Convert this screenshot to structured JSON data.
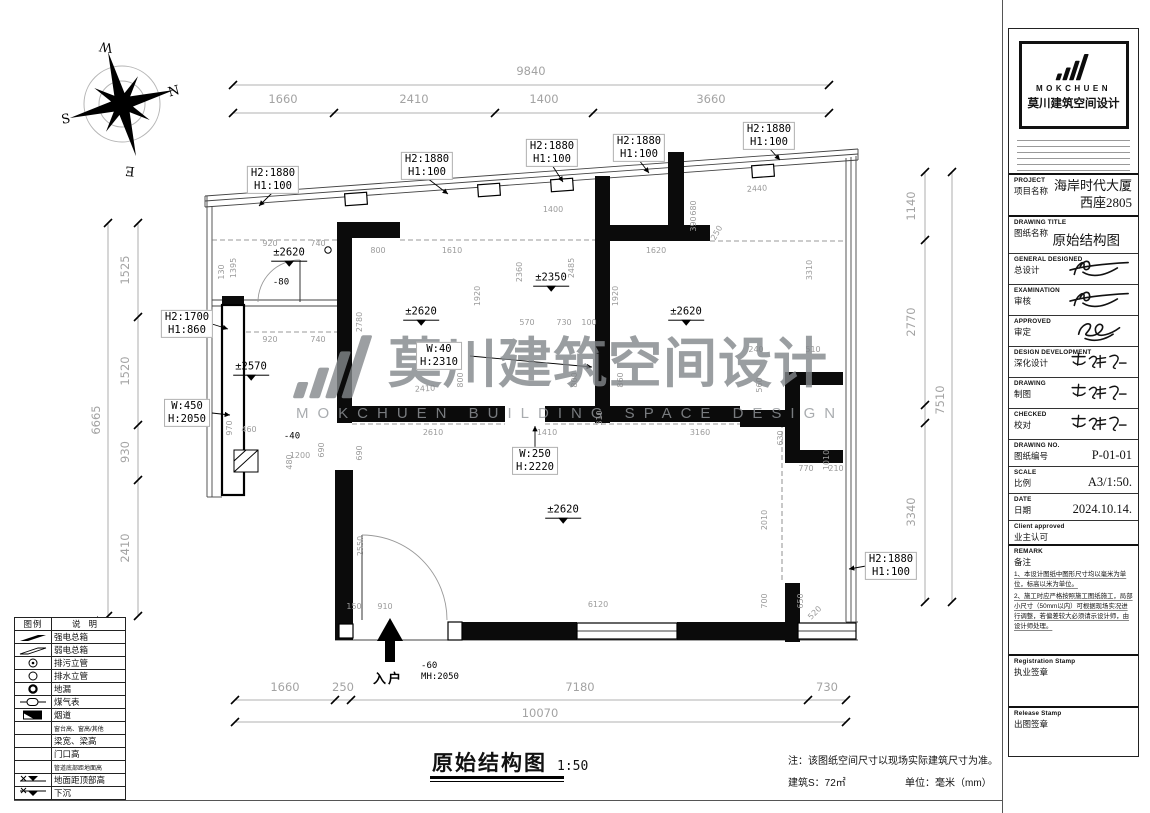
{
  "watermark": {
    "cn": "莫川建筑空间设计",
    "en": "MOKCHUEN BUILDING SPACE DESIGN"
  },
  "plan": {
    "annotations": [
      {
        "t": "chain",
        "s": "9840",
        "x": 531,
        "y": 72
      },
      {
        "t": "chain",
        "s": "1660",
        "x": 283,
        "y": 100
      },
      {
        "t": "chain",
        "s": "2410",
        "x": 414,
        "y": 100
      },
      {
        "t": "chain",
        "s": "1400",
        "x": 544,
        "y": 100
      },
      {
        "t": "chain",
        "s": "3660",
        "x": 711,
        "y": 100
      },
      {
        "t": "chain",
        "s": "6665",
        "x": 97,
        "y": 420,
        "r": -90
      },
      {
        "t": "chain",
        "s": "1525",
        "x": 126,
        "y": 270,
        "r": -90
      },
      {
        "t": "chain",
        "s": "1520",
        "x": 126,
        "y": 371,
        "r": -90
      },
      {
        "t": "chain",
        "s": "930",
        "x": 126,
        "y": 452,
        "r": -90
      },
      {
        "t": "chain",
        "s": "2410",
        "x": 126,
        "y": 548,
        "r": -90
      },
      {
        "t": "chain",
        "s": "1140",
        "x": 912,
        "y": 206,
        "r": -90
      },
      {
        "t": "chain",
        "s": "2770",
        "x": 912,
        "y": 322,
        "r": -90
      },
      {
        "t": "chain",
        "s": "3340",
        "x": 912,
        "y": 512,
        "r": -90
      },
      {
        "t": "chain",
        "s": "7510",
        "x": 941,
        "y": 400,
        "r": -90
      },
      {
        "t": "chain",
        "s": "1660",
        "x": 285,
        "y": 688
      },
      {
        "t": "chain",
        "s": "250",
        "x": 343,
        "y": 688
      },
      {
        "t": "chain",
        "s": "7180",
        "x": 580,
        "y": 688
      },
      {
        "t": "chain",
        "s": "730",
        "x": 827,
        "y": 688
      },
      {
        "t": "chain",
        "s": "10070",
        "x": 540,
        "y": 714
      },
      {
        "t": "box",
        "s": "H2:1880\nH1:100",
        "x": 273,
        "y": 180
      },
      {
        "t": "box",
        "s": "H2:1880\nH1:100",
        "x": 427,
        "y": 166
      },
      {
        "t": "box",
        "s": "H2:1880\nH1:100",
        "x": 552,
        "y": 153
      },
      {
        "t": "box",
        "s": "H2:1880\nH1:100",
        "x": 639,
        "y": 148
      },
      {
        "t": "box",
        "s": "H2:1880\nH1:100",
        "x": 769,
        "y": 136
      },
      {
        "t": "box",
        "s": "H2:1700\nH1:860",
        "x": 187,
        "y": 324
      },
      {
        "t": "box",
        "s": "W:450\nH:2050",
        "x": 187,
        "y": 413
      },
      {
        "t": "box",
        "s": "W:40\nH:2310",
        "x": 439,
        "y": 356
      },
      {
        "t": "box",
        "s": "W:250\nH:2220",
        "x": 535,
        "y": 461
      },
      {
        "t": "box",
        "s": "H2:1880\nH1:100",
        "x": 891,
        "y": 566
      },
      {
        "t": "level",
        "s": "±2620",
        "x": 289,
        "y": 259
      },
      {
        "t": "level",
        "s": "±2350",
        "x": 551,
        "y": 284
      },
      {
        "t": "level",
        "s": "±2620",
        "x": 421,
        "y": 318
      },
      {
        "t": "level",
        "s": "±2620",
        "x": 686,
        "y": 318
      },
      {
        "t": "level",
        "s": "±2570",
        "x": 251,
        "y": 373
      },
      {
        "t": "level",
        "s": "±2620",
        "x": 563,
        "y": 516
      },
      {
        "t": "plain",
        "s": "-80",
        "x": 281,
        "y": 283
      },
      {
        "t": "plain",
        "s": "-40",
        "x": 292,
        "y": 437
      },
      {
        "t": "note2",
        "s": "-60\nMH:2050",
        "x": 440,
        "y": 672
      },
      {
        "t": "entry",
        "s": "入户",
        "x": 388,
        "y": 679
      },
      {
        "t": "compass",
        "s": "N",
        "x": 174,
        "y": 92,
        "r": -15
      },
      {
        "t": "compass",
        "s": "S",
        "x": 66,
        "y": 120,
        "r": -10
      },
      {
        "t": "compass",
        "s": "W",
        "x": 106,
        "y": 46,
        "r": 188
      },
      {
        "t": "compass",
        "s": "E",
        "x": 130,
        "y": 170,
        "r": 185
      },
      {
        "t": "dim",
        "s": "1395",
        "x": 234,
        "y": 268,
        "r": -90
      },
      {
        "t": "dim",
        "s": "920",
        "x": 270,
        "y": 244
      },
      {
        "t": "dim",
        "s": "740",
        "x": 318,
        "y": 244
      },
      {
        "t": "dim",
        "s": "130",
        "x": 222,
        "y": 272,
        "r": -90
      },
      {
        "t": "dim",
        "s": "920",
        "x": 270,
        "y": 340
      },
      {
        "t": "dim",
        "s": "740",
        "x": 318,
        "y": 340
      },
      {
        "t": "dim",
        "s": "970",
        "x": 230,
        "y": 428,
        "r": -90
      },
      {
        "t": "dim",
        "s": "2780",
        "x": 360,
        "y": 322,
        "r": -90
      },
      {
        "t": "dim",
        "s": "800",
        "x": 378,
        "y": 251
      },
      {
        "t": "dim",
        "s": "1610",
        "x": 452,
        "y": 251
      },
      {
        "t": "dim",
        "s": "1920",
        "x": 478,
        "y": 296,
        "r": -90
      },
      {
        "t": "dim",
        "s": "1400",
        "x": 553,
        "y": 210
      },
      {
        "t": "dim",
        "s": "2360",
        "x": 520,
        "y": 272,
        "r": -90
      },
      {
        "t": "dim",
        "s": "2485",
        "x": 572,
        "y": 268,
        "r": -90
      },
      {
        "t": "dim",
        "s": "570",
        "x": 527,
        "y": 323
      },
      {
        "t": "dim",
        "s": "730",
        "x": 564,
        "y": 323
      },
      {
        "t": "dim",
        "s": "100",
        "x": 589,
        "y": 323
      },
      {
        "t": "dim",
        "s": "1620",
        "x": 656,
        "y": 251
      },
      {
        "t": "dim",
        "s": "1920",
        "x": 616,
        "y": 296,
        "r": -90
      },
      {
        "t": "dim",
        "s": "680",
        "x": 694,
        "y": 208,
        "r": -90
      },
      {
        "t": "dim",
        "s": "390",
        "x": 694,
        "y": 224,
        "r": -90
      },
      {
        "t": "dim",
        "s": "250",
        "x": 717,
        "y": 233,
        "r": -60
      },
      {
        "t": "dim",
        "s": "2440",
        "x": 757,
        "y": 189,
        "r": -4
      },
      {
        "t": "dim",
        "s": "3310",
        "x": 810,
        "y": 270,
        "r": -90
      },
      {
        "t": "dim",
        "s": "240",
        "x": 756,
        "y": 350
      },
      {
        "t": "dim",
        "s": "510",
        "x": 813,
        "y": 350
      },
      {
        "t": "dim",
        "s": "560",
        "x": 760,
        "y": 385,
        "r": -90
      },
      {
        "t": "dim",
        "s": "630",
        "x": 781,
        "y": 438,
        "r": -90
      },
      {
        "t": "dim",
        "s": "770",
        "x": 806,
        "y": 469
      },
      {
        "t": "dim",
        "s": "210",
        "x": 836,
        "y": 469
      },
      {
        "t": "dim",
        "s": "460",
        "x": 249,
        "y": 430
      },
      {
        "t": "dim",
        "s": "1200",
        "x": 300,
        "y": 456
      },
      {
        "t": "dim",
        "s": "690",
        "x": 322,
        "y": 450,
        "r": -90
      },
      {
        "t": "dim",
        "s": "480",
        "x": 290,
        "y": 462,
        "r": -90
      },
      {
        "t": "dim",
        "s": "690",
        "x": 360,
        "y": 453,
        "r": -90
      },
      {
        "t": "dim",
        "s": "2610",
        "x": 433,
        "y": 433
      },
      {
        "t": "dim",
        "s": "1410",
        "x": 547,
        "y": 433
      },
      {
        "t": "dim",
        "s": "2410",
        "x": 425,
        "y": 389,
        "r": -3
      },
      {
        "t": "dim",
        "s": "800",
        "x": 461,
        "y": 380,
        "r": -90
      },
      {
        "t": "dim",
        "s": "800",
        "x": 575,
        "y": 380,
        "r": -90
      },
      {
        "t": "dim",
        "s": "860",
        "x": 621,
        "y": 380,
        "r": -90
      },
      {
        "t": "dim",
        "s": "310",
        "x": 600,
        "y": 418,
        "r": -90
      },
      {
        "t": "dim",
        "s": "3160",
        "x": 700,
        "y": 433
      },
      {
        "t": "dim",
        "s": "1010",
        "x": 827,
        "y": 460,
        "r": -90
      },
      {
        "t": "dim",
        "s": "2550",
        "x": 361,
        "y": 546,
        "r": -90
      },
      {
        "t": "dim",
        "s": "150",
        "x": 354,
        "y": 607
      },
      {
        "t": "dim",
        "s": "910",
        "x": 385,
        "y": 607
      },
      {
        "t": "dim",
        "s": "6120",
        "x": 598,
        "y": 605
      },
      {
        "t": "dim",
        "s": "2010",
        "x": 765,
        "y": 520,
        "r": -90
      },
      {
        "t": "dim",
        "s": "700",
        "x": 765,
        "y": 601,
        "r": -90
      },
      {
        "t": "dim",
        "s": "650",
        "x": 801,
        "y": 601,
        "r": -90
      },
      {
        "t": "dim",
        "s": "520",
        "x": 815,
        "y": 613,
        "r": -45
      }
    ]
  },
  "legend": {
    "col1": "图例",
    "col2": "说明",
    "rows": [
      {
        "sym": "strong-box",
        "label": "强电总箱"
      },
      {
        "sym": "weak-box",
        "label": "弱电总箱"
      },
      {
        "sym": "sewage",
        "label": "排污立管"
      },
      {
        "sym": "drain",
        "label": "排水立管"
      },
      {
        "sym": "floor-drain",
        "label": "地漏"
      },
      {
        "sym": "gas-meter",
        "label": "煤气表"
      },
      {
        "sym": "flue",
        "label": "烟道"
      },
      {
        "sym": "none",
        "label": "窗台高、窗高/其他"
      },
      {
        "sym": "none",
        "label": "梁宽、梁高"
      },
      {
        "sym": "none",
        "label": "门口高"
      },
      {
        "sym": "none",
        "label": "管道底部距地面高"
      },
      {
        "sym": "level-top",
        "label": "地面距顶部高"
      },
      {
        "sym": "level-sink",
        "label": "下沉"
      }
    ]
  },
  "footer": {
    "title": "原始结构图",
    "scale": "1:50",
    "note": "注：该图纸空间尺寸以现场实际建筑尺寸为准。",
    "area_label": "建筑S：72㎡",
    "unit_label": "单位：毫米（mm）"
  },
  "titleblock": {
    "brand": {
      "logo_text_en": "MOKCHUEN",
      "logo_text_cn": "莫川建筑空间设计"
    },
    "fields": [
      {
        "k": "project",
        "en": "PROJECT",
        "cn": "项目名称",
        "value": "海岸时代大厦\n西座2805"
      },
      {
        "k": "title",
        "en": "DRAWING TITLE",
        "cn": "图纸名称",
        "value": "原始结构图"
      },
      {
        "k": "sig",
        "en": "GENERAL DESIGNED",
        "cn": "总设计",
        "sig": "a"
      },
      {
        "k": "sig",
        "en": "EXAMINATION",
        "cn": "审核",
        "sig": "a"
      },
      {
        "k": "sig",
        "en": "APPROVED",
        "cn": "审定",
        "sig": "b"
      },
      {
        "k": "sig",
        "en": "DESIGN DEVELOPMENT",
        "cn": "深化设计",
        "sig": "c"
      },
      {
        "k": "sig",
        "en": "DRAWING",
        "cn": "制图",
        "sig": "c"
      },
      {
        "k": "sig",
        "en": "CHECKED",
        "cn": "校对",
        "sig": "c"
      },
      {
        "k": "kv",
        "en": "DRAWING NO.",
        "cn": "图纸编号",
        "value": "P-01-01"
      },
      {
        "k": "kv",
        "en": "SCALE",
        "cn": "比例",
        "value": "A3/1:50."
      },
      {
        "k": "kv",
        "en": "DATE",
        "cn": "日期",
        "value": "2024.10.14."
      },
      {
        "k": "label",
        "en": "Client approved",
        "cn": "业主认可"
      },
      {
        "k": "notes",
        "en": "REMARK",
        "cn": "备注",
        "notes": [
          "1、本设计图纸中图形尺寸均以毫米为单位，标高以米为单位。",
          "2、施工时应严格按照施工图纸施工，局部小尺寸（50mm以内）可根据现场实况进行调整，若偏差较大必须请示设计师，由设计师处理。"
        ]
      },
      {
        "k": "stamp1",
        "en": "Registration Stamp",
        "cn": "执业签章"
      },
      {
        "k": "stamp2",
        "en": "Release Stamp",
        "cn": "出图签章"
      }
    ]
  }
}
